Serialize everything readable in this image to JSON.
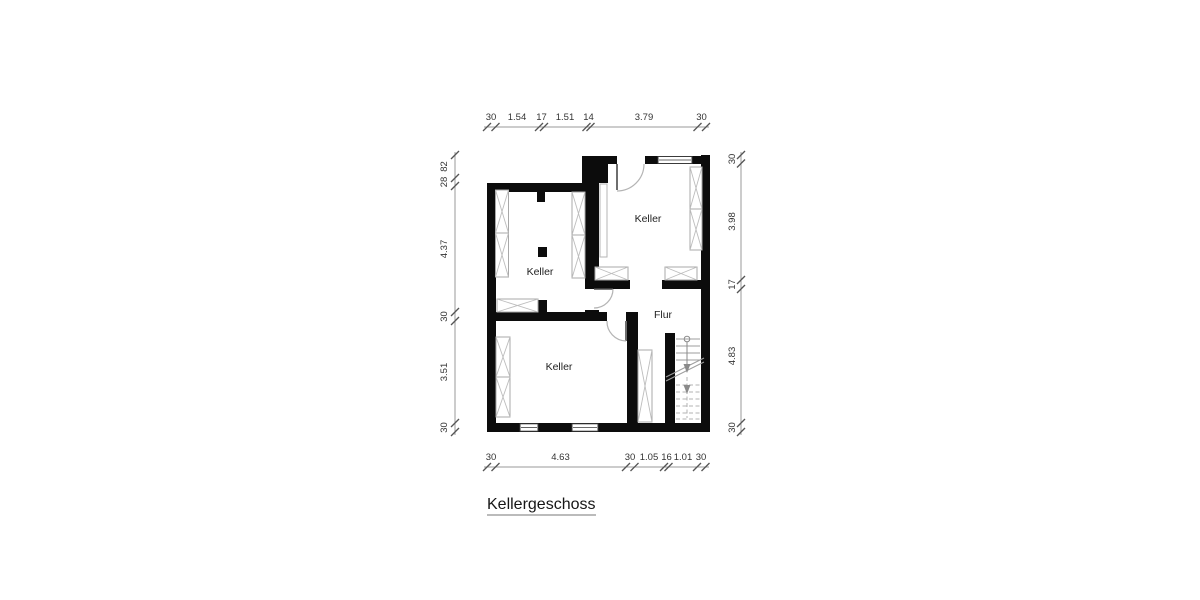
{
  "title": "Kellergeschoss",
  "rooms": {
    "top_left": "Keller",
    "top_right": "Keller",
    "bottom": "Keller",
    "hall": "Flur"
  },
  "dimensions": {
    "top": [
      "30",
      "1.54",
      "17",
      "1.51",
      "14",
      "3.79",
      "30"
    ],
    "bottom": [
      "30",
      "4.63",
      "30",
      "1.05",
      "16",
      "1.01",
      "30"
    ],
    "left": [
      "82",
      "28",
      "4.37",
      "30",
      "3.51",
      "30"
    ],
    "right": [
      "30",
      "3.98",
      "17",
      "4.83",
      "30"
    ]
  },
  "colors": {
    "wall": "#0c0c0c",
    "background": "#ffffff",
    "dimension_line": "#9a9a9a",
    "text": "#222222"
  }
}
